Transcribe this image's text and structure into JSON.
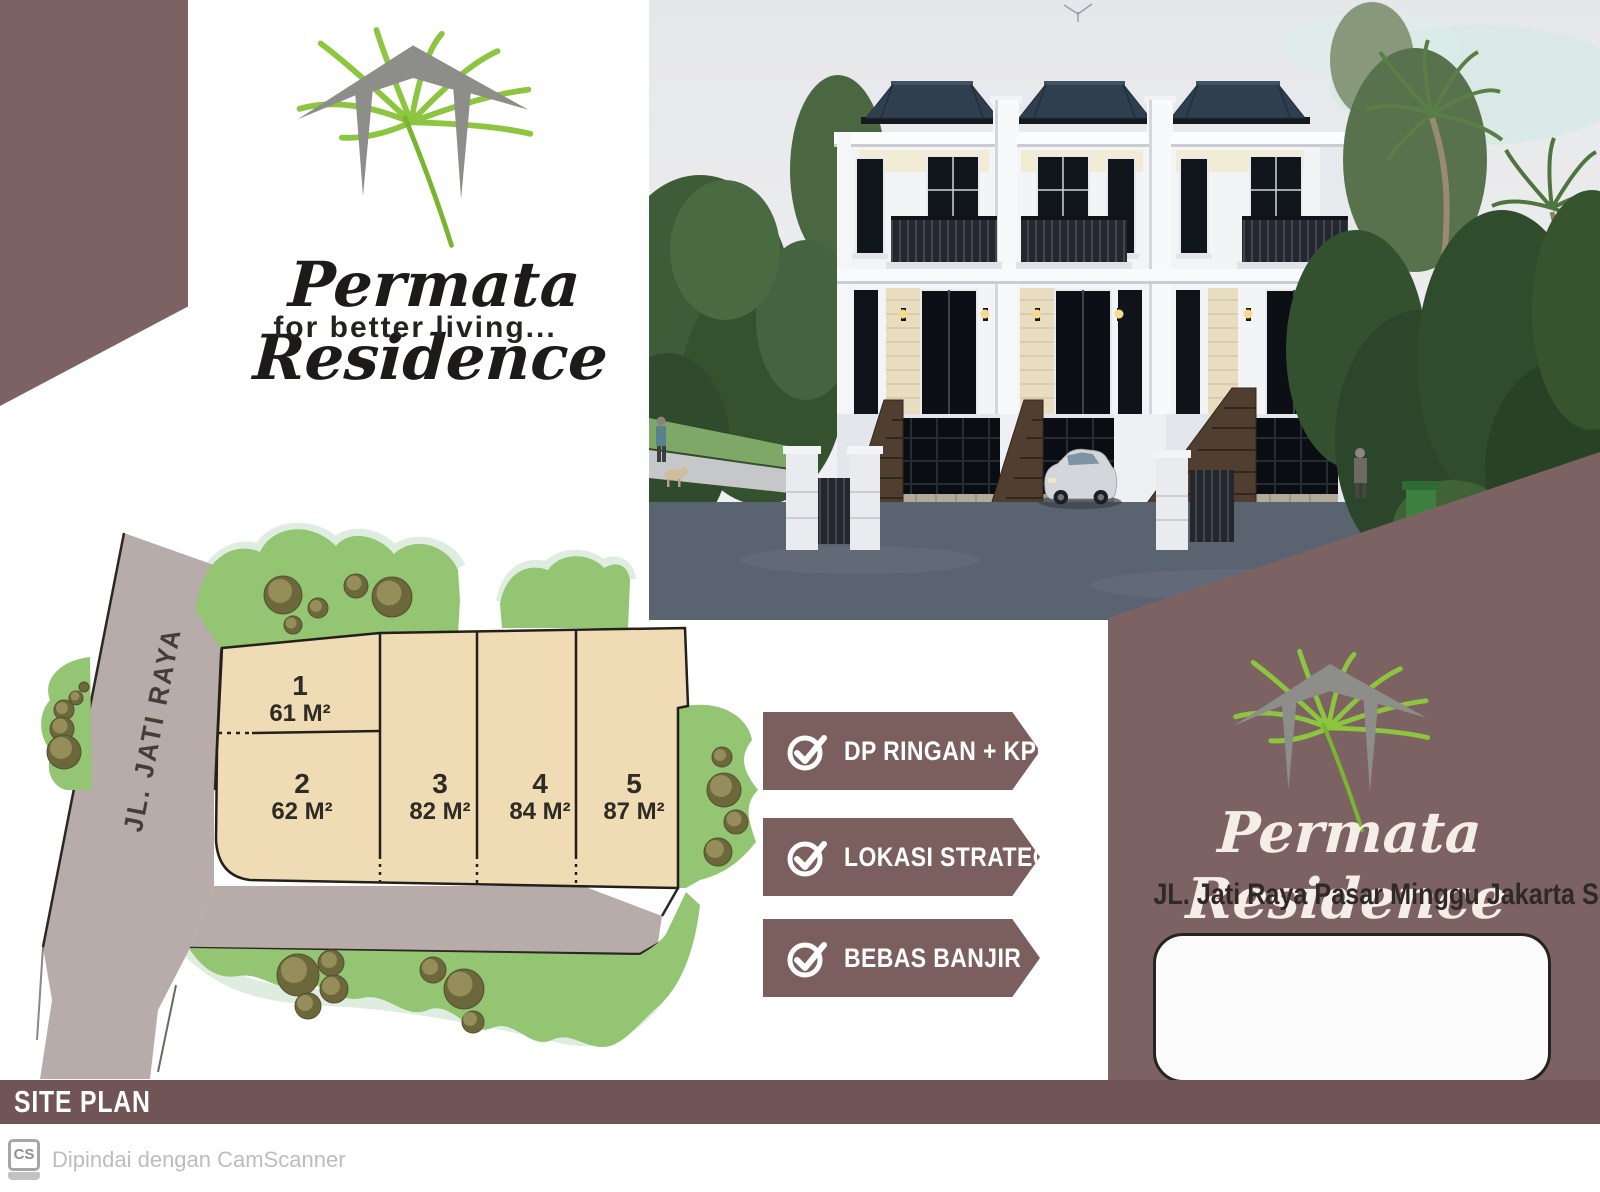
{
  "brand": {
    "name": "Permata Residence",
    "tagline": "for better living..."
  },
  "right_panel": {
    "name": "Permata Residence",
    "address": "JL. Jati  Raya Pasar Minggu  Jakarta Selatan"
  },
  "features": [
    {
      "label": "DP RINGAN + KPR"
    },
    {
      "label": "LOKASI STRATEGIS"
    },
    {
      "label": "BEBAS BANJIR"
    }
  ],
  "site_plan": {
    "title": "SITE PLAN",
    "road_label": "JL. JATI RAYA",
    "lots": [
      {
        "no": "1",
        "area": "61 M²"
      },
      {
        "no": "2",
        "area": "62 M²"
      },
      {
        "no": "3",
        "area": "82 M²"
      },
      {
        "no": "4",
        "area": "84 M²"
      },
      {
        "no": "5",
        "area": "87 M²"
      }
    ]
  },
  "footer": {
    "scanner_logo": "CS",
    "scanner_text": "Dipindai dengan CamScanner"
  },
  "colors": {
    "maroon": "#7d6263",
    "ribbon": "#7b5e5e",
    "bar": "#705456",
    "lot_fill": "#efdcb4",
    "green": "#93c573",
    "road": "#b7acaa",
    "leaf_green": "#8cc63e",
    "roof_logo_gray": "#8d8d89"
  }
}
